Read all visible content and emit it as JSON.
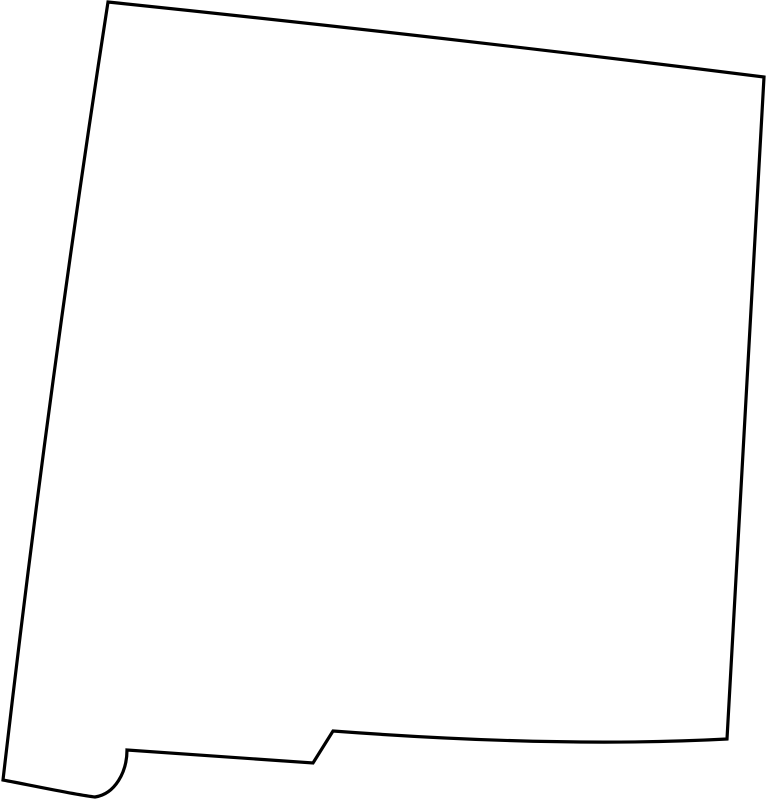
{
  "map": {
    "region_name": "New Mexico",
    "map_type": "state-outline-silhouette",
    "background_color": "#ffffff",
    "outline_color": "#000000",
    "fill_color": "#ffffff",
    "stroke_width": "3.2",
    "viewbox": "0 0 769 800",
    "path_d": "M 108,2 Q 436,36 764,77 L 727,739 Q 560,748 333,731 L 313,763 L 127,750 C 127,772 115,794 95,797 C 76,795 30,785 3,780 Q 48,390 108,2 Z",
    "features": {
      "north_border": "straight, sloping gently down to the right",
      "east_border": "straight, leaning slightly left toward bottom",
      "south_border_east": "gently sagging line from Rio Grande step to southeast corner",
      "rio_grande_step": "diagonal notch joining the two southern border latitudes",
      "south_border_west": "short straight segment west of the step",
      "bootheel": "curled hook at the southwest corner",
      "west_border": "long, slightly bowed line from bootheel up to northwest corner"
    }
  }
}
